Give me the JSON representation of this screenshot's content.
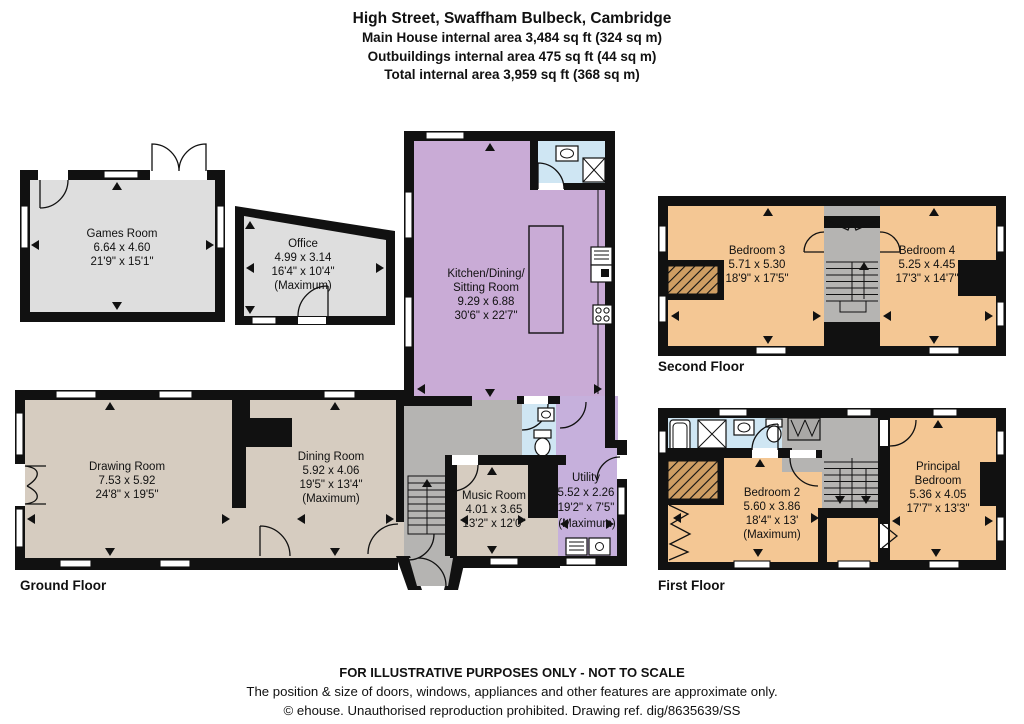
{
  "title": {
    "line1": "High Street, Swaffham Bulbeck, Cambridge",
    "line2": "Main House internal area 3,484 sq ft (324 sq m)",
    "line3": "Outbuildings internal area 475 sq ft (44 sq m)",
    "line4": "Total internal area 3,959 sq ft (368 sq m)"
  },
  "floor_labels": {
    "ground": "Ground Floor",
    "first": "First Floor",
    "second": "Second Floor"
  },
  "rooms": {
    "games": {
      "name": "Games Room",
      "metric": "6.64 x 4.60",
      "imperial": "21'9\" x 15'1\""
    },
    "office": {
      "name": "Office",
      "metric": "4.99 x 3.14",
      "imperial": "16'4\" x 10'4\"",
      "note": "(Maximum)"
    },
    "kitchen": {
      "name1": "Kitchen/Dining/",
      "name2": "Sitting Room",
      "metric": "9.29 x 6.88",
      "imperial": "30'6\" x 22'7\""
    },
    "drawing": {
      "name": "Drawing Room",
      "metric": "7.53 x 5.92",
      "imperial": "24'8\" x 19'5\""
    },
    "dining": {
      "name": "Dining Room",
      "metric": "5.92 x 4.06",
      "imperial": "19'5\" x 13'4\"",
      "note": "(Maximum)"
    },
    "music": {
      "name": "Music Room",
      "metric": "4.01 x 3.65",
      "imperial": "13'2\" x 12'0\""
    },
    "utility": {
      "name": "Utility",
      "metric": "5.52 x 2.26",
      "imperial": "19'2\" x 7'5\"",
      "note": "(Maximum)"
    },
    "bedroom2": {
      "name": "Bedroom 2",
      "metric": "5.60 x 3.86",
      "imperial": "18'4\" x 13'",
      "note": "(Maximum)"
    },
    "principal": {
      "name1": "Principal",
      "name2": "Bedroom",
      "metric": "5.36 x 4.05",
      "imperial": "17'7\" x 13'3\""
    },
    "bedroom3": {
      "name": "Bedroom 3",
      "metric": "5.71 x 5.30",
      "imperial": "18'9\" x 17'5\""
    },
    "bedroom4": {
      "name": "Bedroom 4",
      "metric": "5.25 x 4.45",
      "imperial": "17'3\" x 14'7\""
    }
  },
  "footer": {
    "line1": "FOR ILLUSTRATIVE PURPOSES ONLY - NOT TO SCALE",
    "line2": "The position & size of doors, windows, appliances and other features are approximate only.",
    "line3": "© ehouse. Unauthorised reproduction prohibited. Drawing ref. dig/8635639/SS"
  },
  "colors": {
    "wall": "#111111",
    "outbuilding_fill": "#dedede",
    "ground_fill": "#d6ccc0",
    "kitchen_fill": "#c9abd6",
    "utility_fill": "#c6b0dc",
    "bedroom_fill": "#f4c794",
    "bathroom_fill": "#cfe6f3",
    "hall_fill": "#b5b4b2",
    "hatch_fill": "#cf9e63"
  }
}
